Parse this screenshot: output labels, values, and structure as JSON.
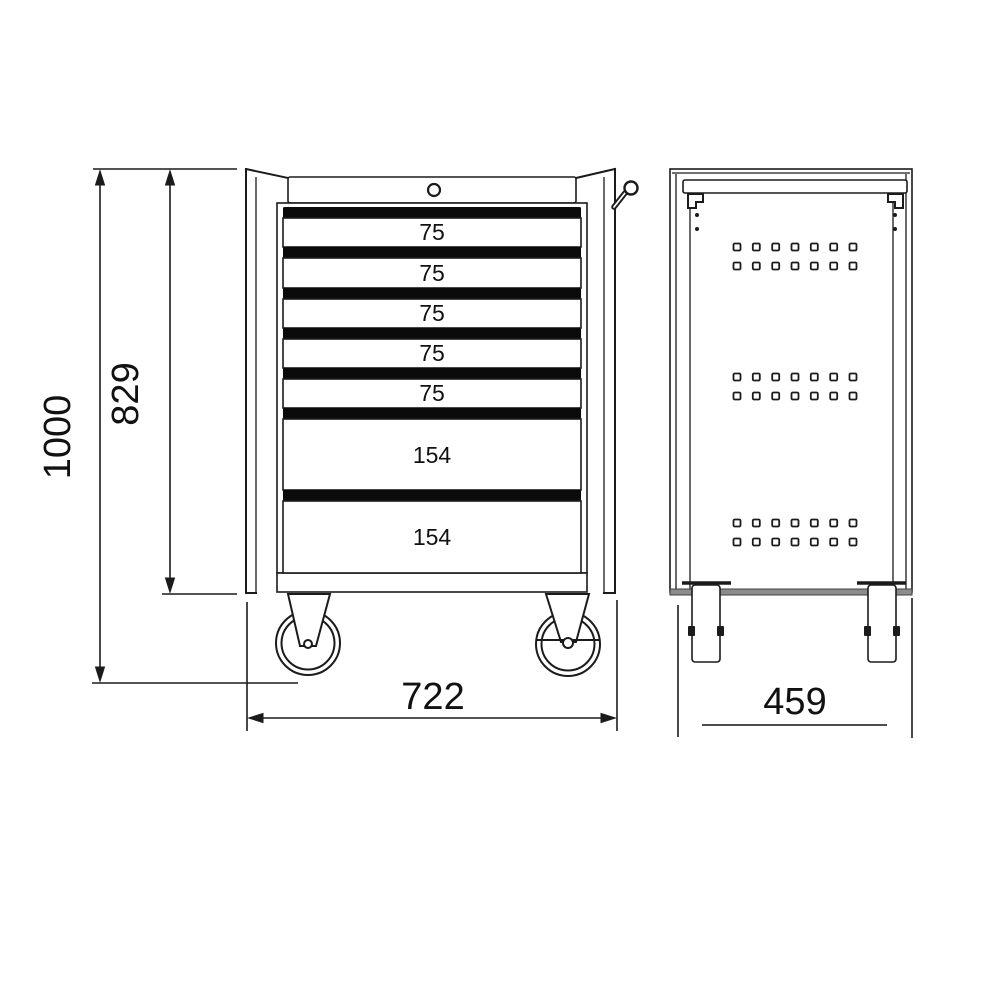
{
  "front_view": {
    "drawers": [
      {
        "label": "75"
      },
      {
        "label": "75"
      },
      {
        "label": "75"
      },
      {
        "label": "75"
      },
      {
        "label": "75"
      },
      {
        "label": "154"
      },
      {
        "label": "154"
      }
    ]
  },
  "side_view": {
    "perforations": {
      "groups": 3,
      "rows_per_group": 2,
      "columns": 7
    }
  },
  "dimensions": {
    "overall_height": "1000",
    "cabinet_height": "829",
    "overall_width": "722",
    "depth": "459"
  },
  "colors": {
    "line": "#1b1b1b",
    "drawer_bar": "#0b0b0b",
    "base_strip": "#8c8c8c",
    "dim_gray": "#4e4e4e",
    "background": "#ffffff"
  }
}
